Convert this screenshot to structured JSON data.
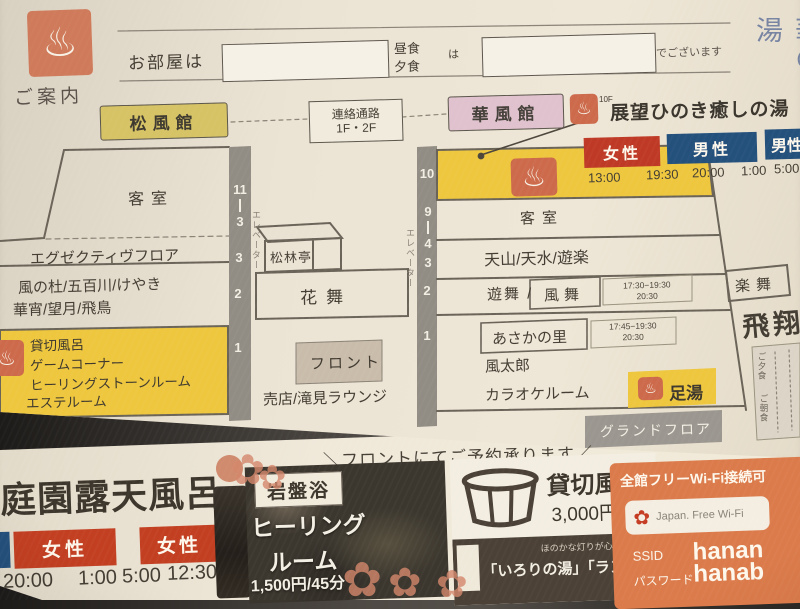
{
  "header": {
    "guide_label": "ご案内",
    "room_label": "お部屋は",
    "lunch_label": "昼食",
    "dinner_label": "夕食",
    "particle": "は",
    "suffix": "でございます",
    "logo_text": "華の湯"
  },
  "map": {
    "matsukaze_wing": "松風館",
    "corridor_line1": "連絡通路",
    "corridor_line2": "1F・2F",
    "hana_wing": "華風館",
    "rooftop": {
      "floor_tag": "10F",
      "label": "展望ひのき癒しの湯",
      "female": "女性",
      "male": "男性",
      "male2": "男性",
      "times": [
        "13:00",
        "19:30",
        "20:00",
        "1:00",
        "5:00"
      ]
    },
    "left_building": {
      "guest_rooms": "客室",
      "floors": [
        "11",
        "3",
        "3",
        "2",
        "1"
      ],
      "elevator": "エレベーター",
      "executive_floor": "エグゼクティヴフロア",
      "dining1": "風の杜/五百川/けやき",
      "dining2": "華宵/望月/飛鳥",
      "facility1": "貸切風呂",
      "facility2": "ゲームコーナー",
      "facility3": "ヒーリングストーンルーム",
      "facility4": "エステルーム",
      "shorintei": "松林亭",
      "hanamai": "花舞",
      "front_desk": "フロント",
      "shop": "売店/滝見ラウンジ"
    },
    "right_building": {
      "floors": [
        "10",
        "9",
        "4",
        "3",
        "2",
        "1"
      ],
      "elevator": "エレベーター",
      "guest_rooms": "客室",
      "tenzan_row": "天山/天水/遊楽",
      "yumai": "遊舞 /",
      "kazamai": "風舞",
      "kazamai_time1": "17:30−19:30",
      "kazamai_time2": "20:30",
      "asaka": "あさかの里",
      "asaka_time1": "17:45−19:30",
      "asaka_time2": "20:30",
      "futaro": "風太郎",
      "karaoke": "カラオケルーム",
      "ashiyu": "足湯",
      "rakumai": "楽舞",
      "hisho": "飛翔",
      "legend1": "ご夕食",
      "legend2": "ご朝食",
      "ground_floor": "グランドフロア"
    },
    "note": "＼フロントにてご予約承ります／"
  },
  "bottom": {
    "rotenburo": {
      "title": "庭園露天風呂",
      "female1": "女性",
      "female2": "女性",
      "times": [
        "20:00",
        "1:00",
        "5:00",
        "12:30"
      ]
    },
    "ganban": {
      "title": "岩盤浴",
      "line1": "ヒーリング",
      "line2": "ルーム",
      "price": "1,500円/45分"
    },
    "kashikiri": {
      "title": "貸切風呂",
      "price": "3,000円/45分",
      "caption": "ほのかな灯りが心地よい",
      "baths": "「いろりの湯」「ランプの湯」"
    },
    "wifi": {
      "title": "全館フリーWi-Fi接続可",
      "provider": "Japan. Free Wi-Fi",
      "ssid_label": "SSID",
      "ssid_value": "hanan",
      "password_label": "パスワード",
      "password_value": "hanab"
    }
  }
}
